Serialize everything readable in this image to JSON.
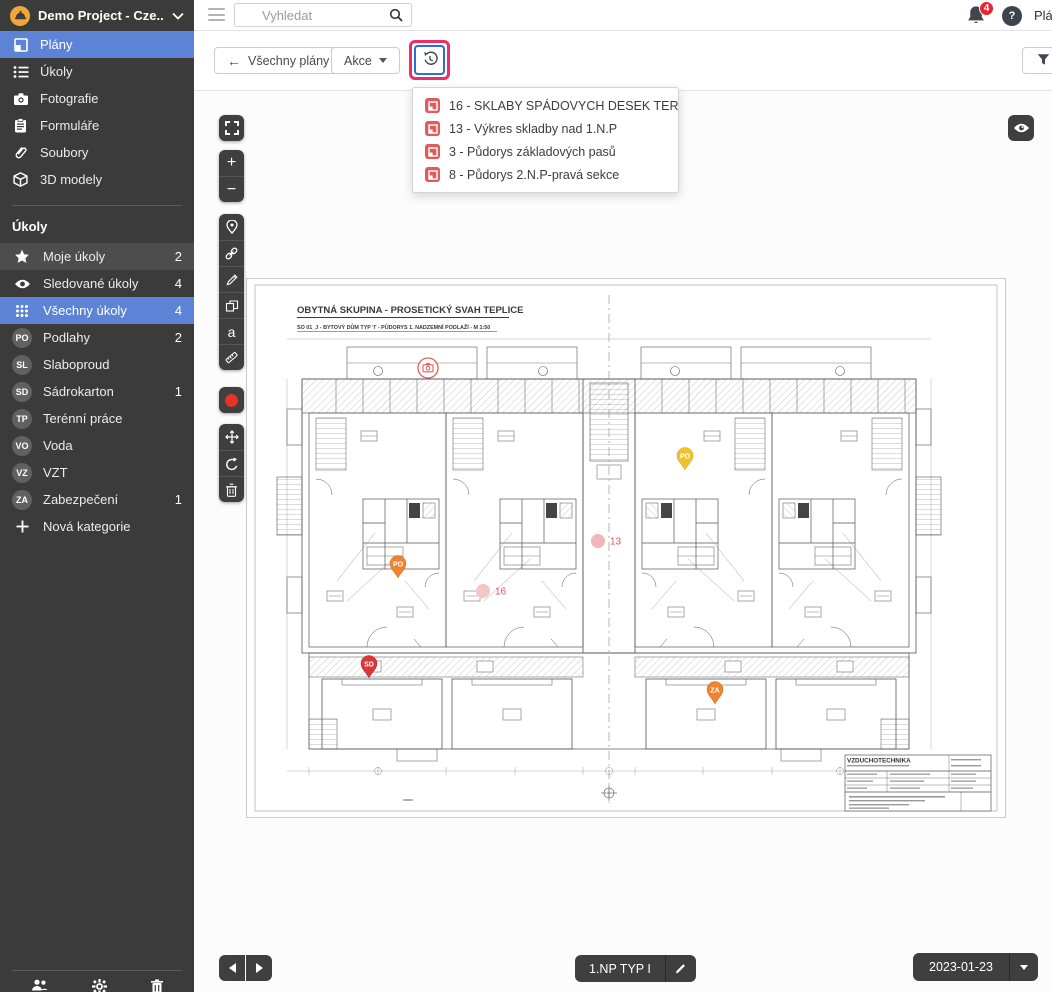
{
  "project": {
    "name": "Demo Project - Cze..."
  },
  "header": {
    "search_placeholder": "Vyhledat",
    "notification_count": "4",
    "help_label": "?",
    "top_right_text": "Plány"
  },
  "toolbar": {
    "back_label": "Všechny plány",
    "actions_label": "Akce",
    "filter_label": "Filtr"
  },
  "history_dropdown": {
    "items": [
      {
        "icon": "plan-icon",
        "label": "16 - SKLABY SPÁDOVYCH DESEK TERAS…"
      },
      {
        "icon": "plan-icon",
        "label": "13 - Výkres skladby nad 1.N.P"
      },
      {
        "icon": "plan-icon",
        "label": "3 - Půdorys základových pasů"
      },
      {
        "icon": "plan-icon",
        "label": "8 - Půdorys 2.N.P-pravá sekce"
      }
    ]
  },
  "sidebar": {
    "nav": [
      {
        "label": "Plány",
        "icon": "plans-icon",
        "selected": true
      },
      {
        "label": "Úkoly",
        "icon": "task-list-icon"
      },
      {
        "label": "Fotografie",
        "icon": "camera-icon"
      },
      {
        "label": "Formuláře",
        "icon": "clipboard-icon"
      },
      {
        "label": "Soubory",
        "icon": "paperclip-icon"
      },
      {
        "label": "3D modely",
        "icon": "cube-icon"
      }
    ],
    "tasks_section_title": "Úkoly",
    "tasks": [
      {
        "label": "Moje úkoly",
        "count": "2",
        "icon": "star-icon"
      },
      {
        "label": "Sledované úkoly",
        "count": "4",
        "icon": "eye-icon"
      },
      {
        "label": "Všechny úkoly",
        "count": "4",
        "icon": "grid-icon",
        "selected": true
      },
      {
        "label": "Podlahy",
        "count": "2",
        "badge": "PO"
      },
      {
        "label": "Slaboproud",
        "count": "",
        "badge": "SL"
      },
      {
        "label": "Sádrokarton",
        "count": "1",
        "badge": "SD"
      },
      {
        "label": "Terénní práce",
        "count": "",
        "badge": "TP"
      },
      {
        "label": "Voda",
        "count": "",
        "badge": "VO"
      },
      {
        "label": "VZT",
        "count": "",
        "badge": "VZ"
      },
      {
        "label": "Zabezpečení",
        "count": "1",
        "badge": "ZA"
      },
      {
        "label": "Nová kategorie",
        "count": "",
        "icon": "plus-icon"
      }
    ]
  },
  "plan": {
    "title": "OBYTNÁ SKUPINA - PROSETICKÝ SVAH TEPLICE",
    "subtitle": "SO 01_J - BYTOVÝ DŮM TYP 'I' - PŮDORYS 1. NADZEMNÍ PODLAŽÍ - M 1:50",
    "titleblock_heading": "VZDUCHOTECHNIKA",
    "markers": [
      {
        "type": "camera",
        "label": ""
      },
      {
        "type": "pin",
        "label": "PO",
        "color": "#eec32d"
      },
      {
        "type": "dot",
        "label": "13"
      },
      {
        "type": "pin",
        "label": "PO",
        "color": "#ef8331"
      },
      {
        "type": "dot",
        "label": "16"
      },
      {
        "type": "pin",
        "label": "SD",
        "color": "#d8383a"
      },
      {
        "type": "pin",
        "label": "ZA",
        "color": "#ef8331"
      }
    ]
  },
  "footer": {
    "plan_name": "1.NP TYP I",
    "date": "2023-01-23"
  },
  "colors": {
    "sidebar_selected": "#5c83d6",
    "annotation_highlight": "#ee2d68",
    "record_red": "#e6332a",
    "notification_badge": "#e8242e",
    "dropdown_icon_red": "#e05c5c",
    "history_button_border": "#2f6bd7"
  }
}
